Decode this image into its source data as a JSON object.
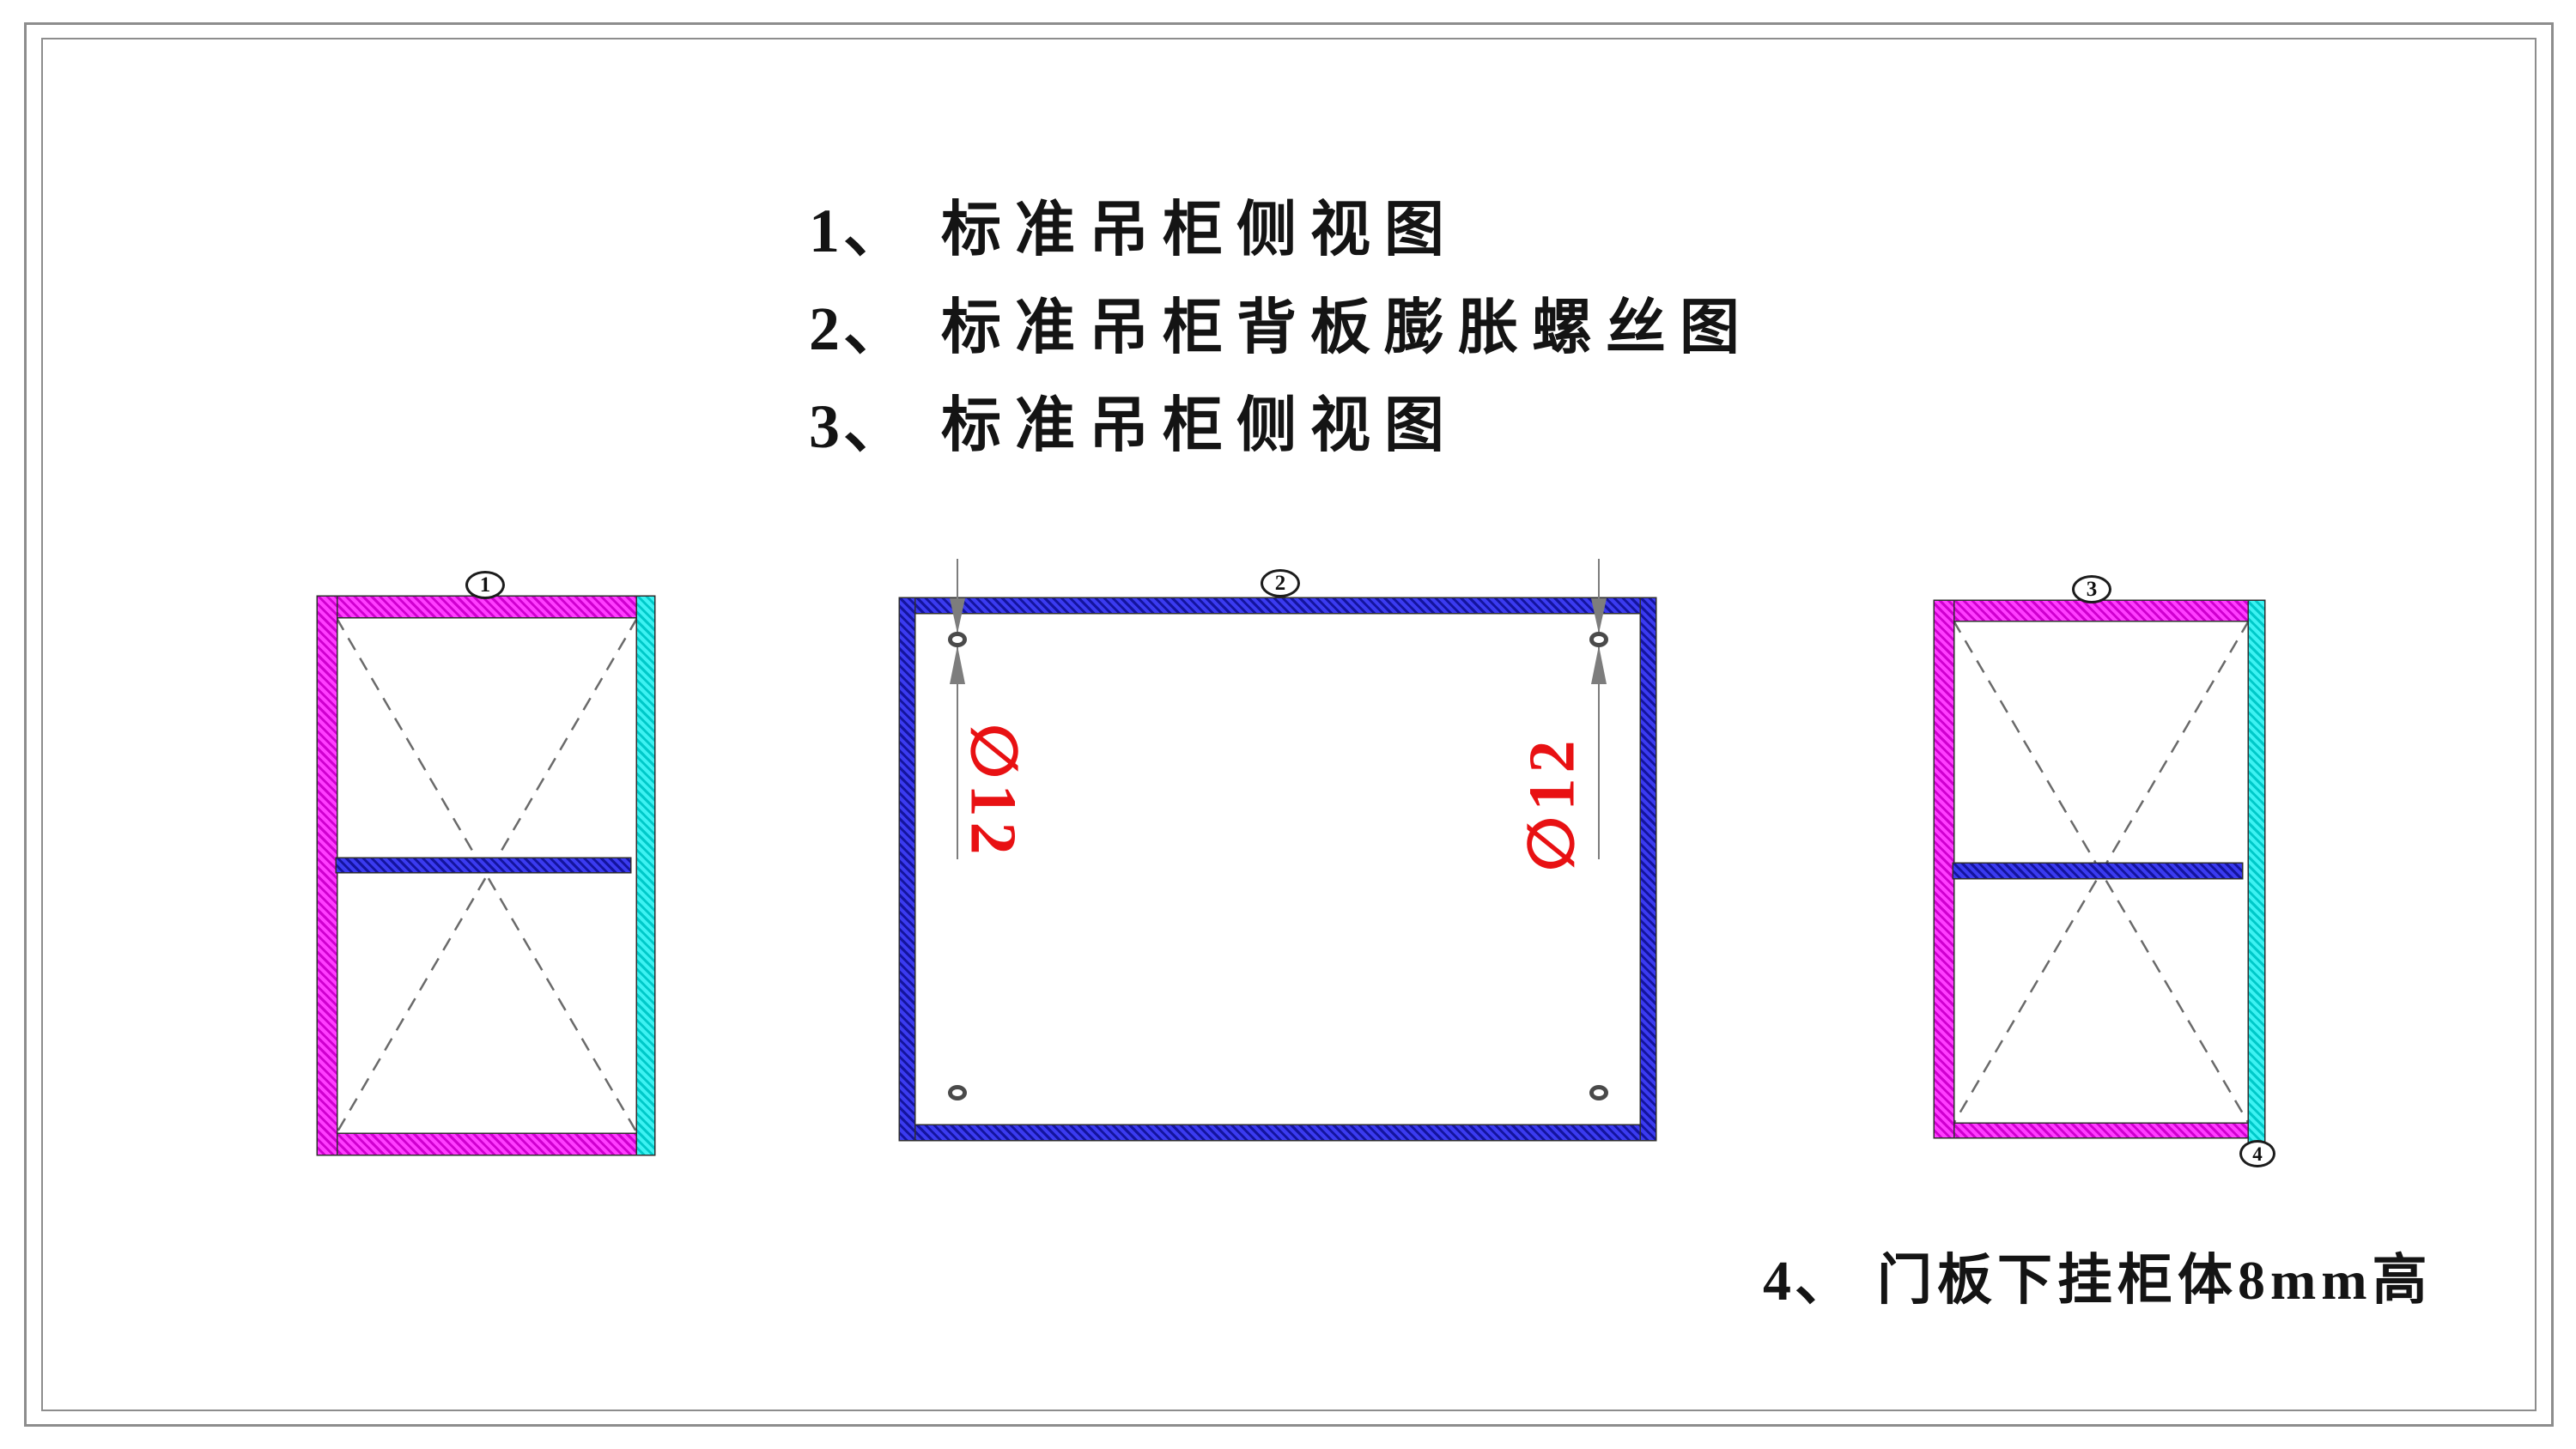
{
  "colors": {
    "magenta": "#ff3dff",
    "magentaDark": "#cf00cf",
    "cyan": "#3df2f2",
    "cyanDark": "#00c9c9",
    "blue": "#3b3bf0",
    "blueDark": "#14149e",
    "red": "#e81113",
    "dimgray": "#7d7d7d",
    "dash": "#6a6a6a",
    "outline": "#2f2f2f",
    "frame": "#8d8d8d",
    "ink": "#141414"
  },
  "title_list": [
    {
      "num": "1、",
      "text": "标准吊柜侧视图"
    },
    {
      "num": "2、",
      "text": "标准吊柜背板膨胀螺丝图"
    },
    {
      "num": "3、",
      "text": "标准吊柜侧视图"
    }
  ],
  "bottom_note": {
    "num": "4、",
    "text": "门板下挂柜体8mm高"
  },
  "balloons": {
    "b1": "1",
    "b2": "2",
    "b3": "3",
    "b4": "4"
  },
  "dim_labels": {
    "left": "∅12",
    "right": "∅12"
  }
}
